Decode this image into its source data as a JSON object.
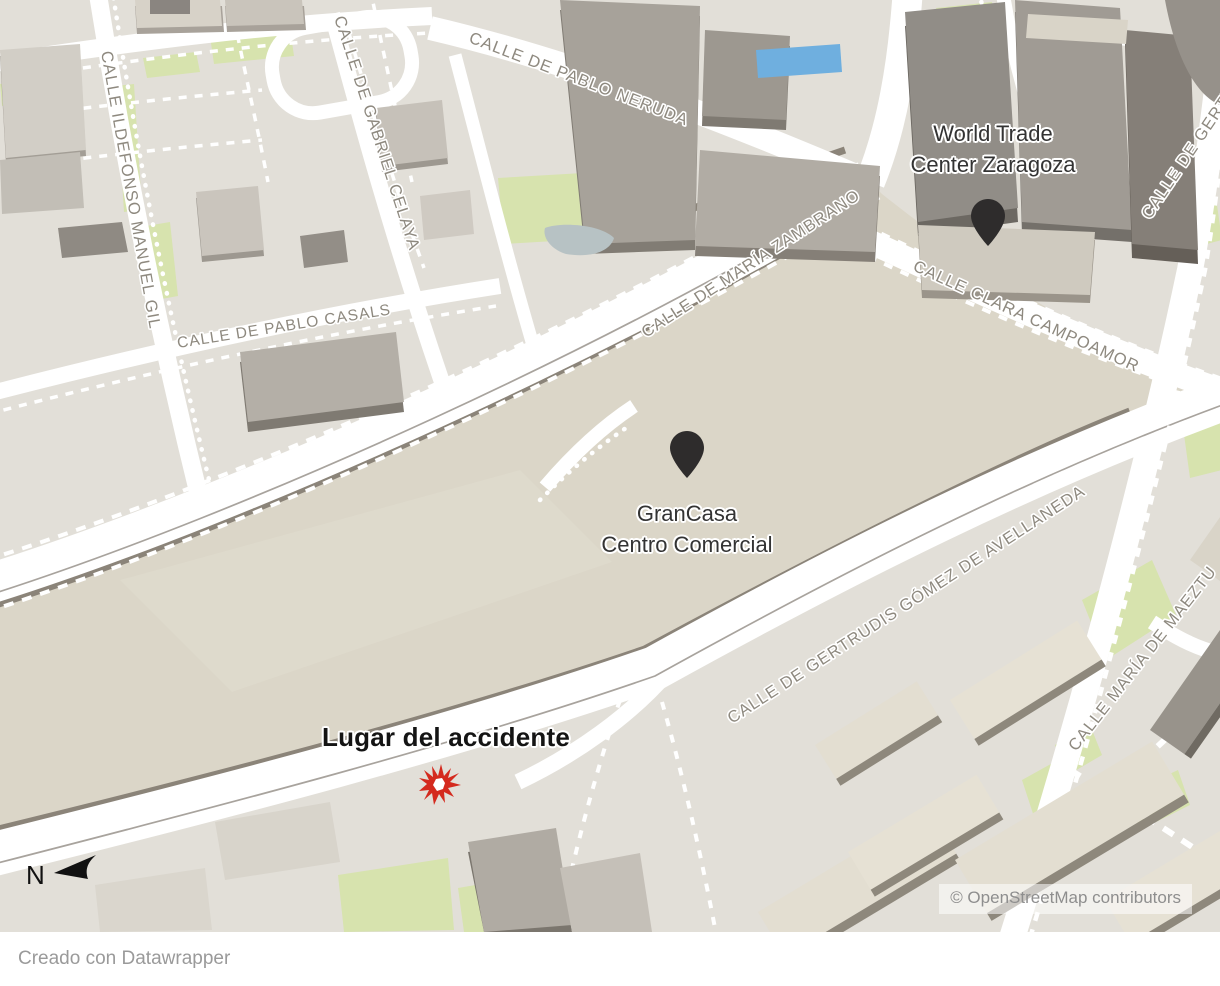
{
  "map": {
    "places": {
      "wtc": {
        "name": "World Trade Center Zaragoza",
        "line1": "World Trade",
        "line2": "Center Zaragoza"
      },
      "grancasa": {
        "name": "GranCasa Centro Comercial",
        "line1": "GranCasa",
        "line2": "Centro Comercial"
      },
      "accident": {
        "name": "Lugar del accidente"
      }
    },
    "streets": [
      {
        "name": "CALLE DE PABLO NERUDA"
      },
      {
        "name": "CALLE DE GABRIEL CELAYA"
      },
      {
        "name": "CALLE ILDEFONSO MANUEL GIL"
      },
      {
        "name": "CALLE DE PABLO CASALS"
      },
      {
        "name": "CALLE DE MARÍA ZAMBRANO"
      },
      {
        "name": "CALLE CLARA CAMPOAMOR"
      },
      {
        "name": "CALLE DE GERTRUDIS GÓMEZ DE AVELLANEDA"
      },
      {
        "name": "CALLE MARÍA DE MAEZTU"
      },
      {
        "name": "CALLE DE GERTRUDIS GÓMEZ DE AVELLANEDA"
      }
    ],
    "north": {
      "label": "N"
    },
    "attribution": "© OpenStreetMap contributors",
    "colors": {
      "land": "#e2dfd8",
      "block": "#dbd6c8",
      "road": "#ffffff",
      "road_edge_dark": "#8b8479",
      "green": "#d7e3ae",
      "water_pool": "#6fafdf",
      "water_pond": "#b7c2c4",
      "building_roof": "#b1aca4",
      "building_side": "#7d7871",
      "marker_pin": "#2e2c2c",
      "accident_red": "#d42a1e",
      "street_label": "#8e897f",
      "place_label": "#333333"
    }
  },
  "footer": {
    "credit": "Creado con Datawrapper"
  }
}
